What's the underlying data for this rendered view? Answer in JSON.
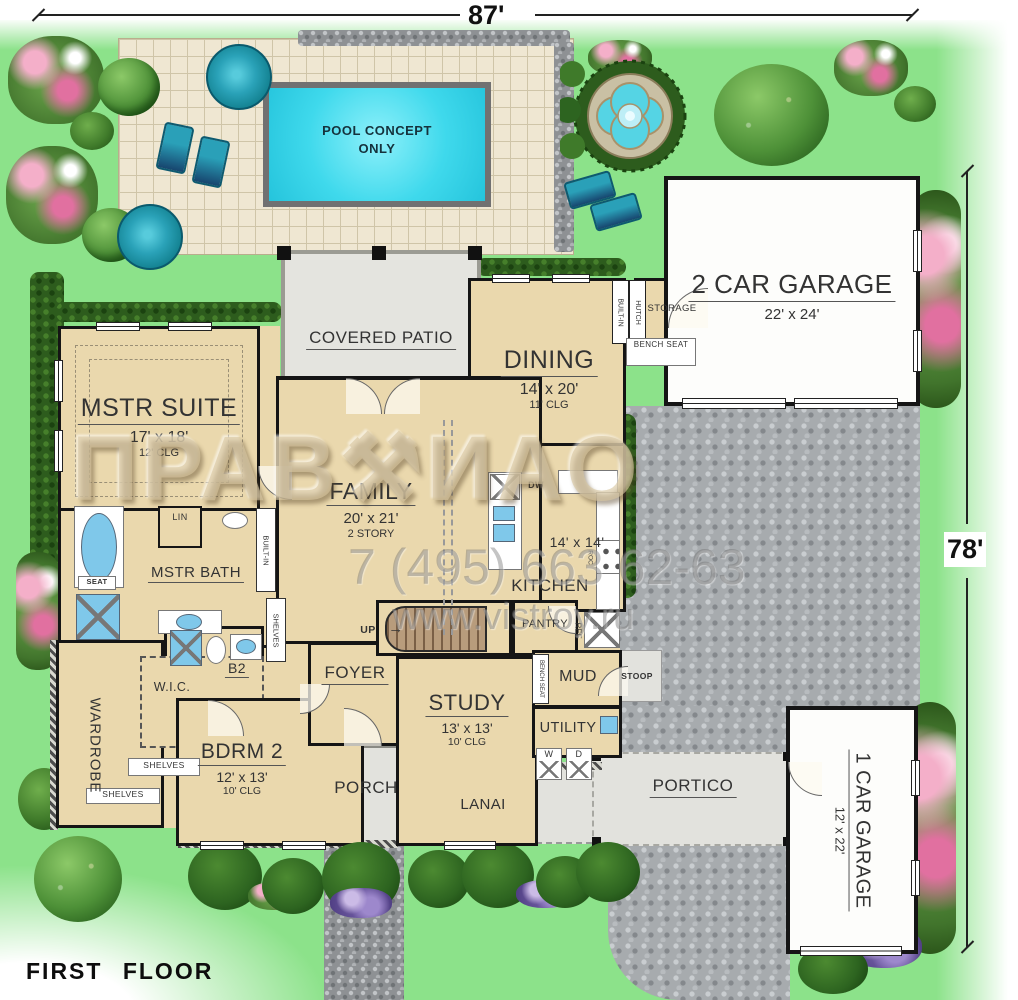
{
  "title": "FIRST FLOOR",
  "dimensions": {
    "width": "87'",
    "height": "78'"
  },
  "watermark": {
    "part1": "ПРАВ",
    "icon": "⚒",
    "part2": "ИАО",
    "phone": "7 (495) 663 62-63",
    "site": "www.vistroy.ru"
  },
  "pool": {
    "line1": "POOL CONCEPT",
    "line2": "ONLY"
  },
  "rooms": {
    "covered_patio": {
      "name": "COVERED PATIO"
    },
    "mstr_suite": {
      "name": "MSTR SUITE",
      "size": "17' x 18'",
      "clg": "12' CLG"
    },
    "dining": {
      "name": "DINING",
      "size": "14' x 20'",
      "clg": "11' CLG"
    },
    "garage2": {
      "name": "2 CAR GARAGE",
      "size": "22' x 24'"
    },
    "family": {
      "name": "FAMILY",
      "size": "20' x 21'",
      "note": "2 STORY"
    },
    "kitchen": {
      "name": "KITCHEN",
      "size": "14' x 14'"
    },
    "mstr_bath": {
      "name": "MSTR BATH"
    },
    "wardrobe": {
      "name": "WARDROBE"
    },
    "wic": {
      "name": "W.I.C."
    },
    "b2": {
      "name": "B2"
    },
    "bdrm2": {
      "name": "BDRM 2",
      "size": "12' x 13'",
      "clg": "10' CLG"
    },
    "foyer": {
      "name": "FOYER"
    },
    "study": {
      "name": "STUDY",
      "size": "13' x 13'",
      "clg": "10' CLG"
    },
    "pantry": {
      "name": "PANTRY"
    },
    "mud": {
      "name": "MUD"
    },
    "utility": {
      "name": "UTILITY"
    },
    "porch": {
      "name": "PORCH"
    },
    "lanai": {
      "name": "LANAI"
    },
    "portico": {
      "name": "PORTICO"
    },
    "stoop": {
      "name": "STOOP"
    },
    "storage": {
      "name": "STORAGE"
    },
    "garage1": {
      "name": "1 CAR GARAGE",
      "size": "12' x 22'"
    }
  },
  "fixtures": {
    "up": "UP",
    "up_arrow": "→",
    "dw": "DW",
    "ref": "REF",
    "roc": "ROC",
    "lin": "LIN",
    "seat": "SEAT",
    "shelves": "SHELVES",
    "built_in": "BUILT-IN",
    "hutch": "HUTCH",
    "bench_seat": "BENCH SEAT",
    "washer": "W",
    "dryer": "D"
  },
  "colors": {
    "lawn": "#8CE28A",
    "room_fill": "#EAD8AD",
    "pool_water": "#2ED0E8",
    "cobble": "#A7ABAE",
    "deck_tile": "#EFE7D2",
    "wall": "#151515",
    "gray_floor": "#E2E2DD",
    "hedge": "#2D5C1D",
    "umbrella": "#2AA2B8"
  }
}
